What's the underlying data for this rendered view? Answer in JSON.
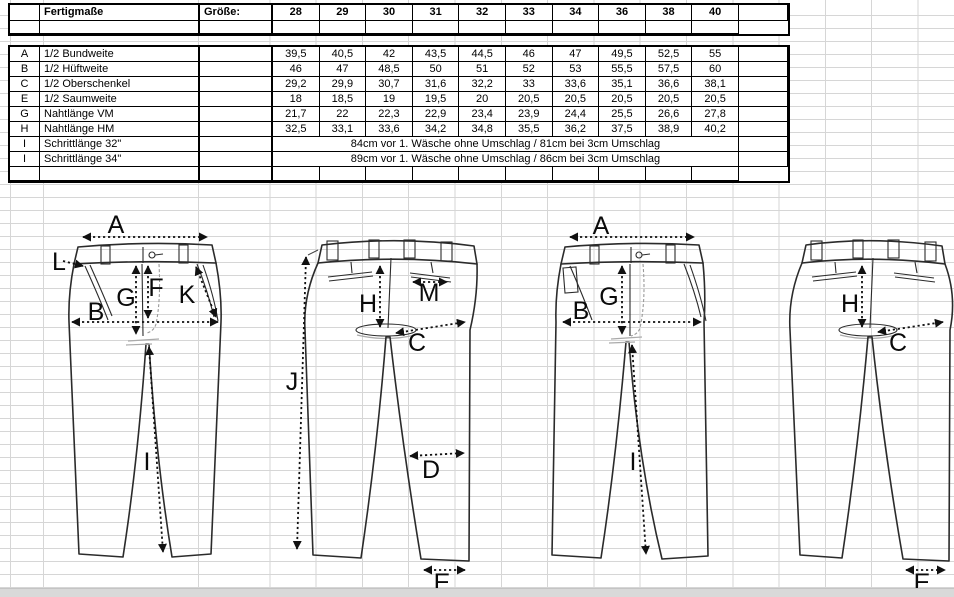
{
  "table": {
    "title": "Fertigmaße",
    "size_label": "Größe:",
    "sizes": [
      "28",
      "29",
      "30",
      "31",
      "32",
      "33",
      "34",
      "36",
      "38",
      "40"
    ],
    "rows": [
      {
        "key": "A",
        "label": "1/2 Bundweite",
        "values": [
          "39,5",
          "40,5",
          "42",
          "43,5",
          "44,5",
          "46",
          "47",
          "49,5",
          "52,5",
          "55"
        ]
      },
      {
        "key": "B",
        "label": "1/2 Hüftweite",
        "values": [
          "46",
          "47",
          "48,5",
          "50",
          "51",
          "52",
          "53",
          "55,5",
          "57,5",
          "60"
        ]
      },
      {
        "key": "C",
        "label": "1/2 Oberschenkel",
        "values": [
          "29,2",
          "29,9",
          "30,7",
          "31,6",
          "32,2",
          "33",
          "33,6",
          "35,1",
          "36,6",
          "38,1"
        ]
      },
      {
        "key": "E",
        "label": "1/2 Saumweite",
        "values": [
          "18",
          "18,5",
          "19",
          "19,5",
          "20",
          "20,5",
          "20,5",
          "20,5",
          "20,5",
          "20,5"
        ]
      },
      {
        "key": "G",
        "label": "Nahtlänge VM",
        "values": [
          "21,7",
          "22",
          "22,3",
          "22,9",
          "23,4",
          "23,9",
          "24,4",
          "25,5",
          "26,6",
          "27,8"
        ]
      },
      {
        "key": "H",
        "label": "Nahtlänge HM",
        "values": [
          "32,5",
          "33,1",
          "33,6",
          "34,2",
          "34,8",
          "35,5",
          "36,2",
          "37,5",
          "38,9",
          "40,2"
        ]
      }
    ],
    "span_rows": [
      {
        "key": "I",
        "label": "Schrittlänge 32\"",
        "text": "84cm vor 1. Wäsche ohne Umschlag / 81cm bei 3cm Umschlag"
      },
      {
        "key": "I",
        "label": "Schrittlänge 34\"",
        "text": "89cm vor 1. Wäsche ohne Umschlag / 86cm bei 3cm Umschlag"
      }
    ]
  },
  "diagram": {
    "front_detail": {
      "A": "A",
      "L": "L",
      "B": "B",
      "G": "G",
      "F": "F",
      "K": "K",
      "I": "I"
    },
    "back_detail": {
      "J": "J",
      "H": "H",
      "M": "M",
      "C": "C",
      "D": "D",
      "E": "E"
    },
    "front_simple": {
      "A": "A",
      "B": "B",
      "G": "G",
      "I": "I"
    },
    "back_simple": {
      "H": "H",
      "C": "C",
      "E": "E"
    }
  },
  "colors": {
    "grid_line": "#d6d6d6",
    "table_border": "#000000",
    "scrollbar": "#d9d9d9"
  }
}
